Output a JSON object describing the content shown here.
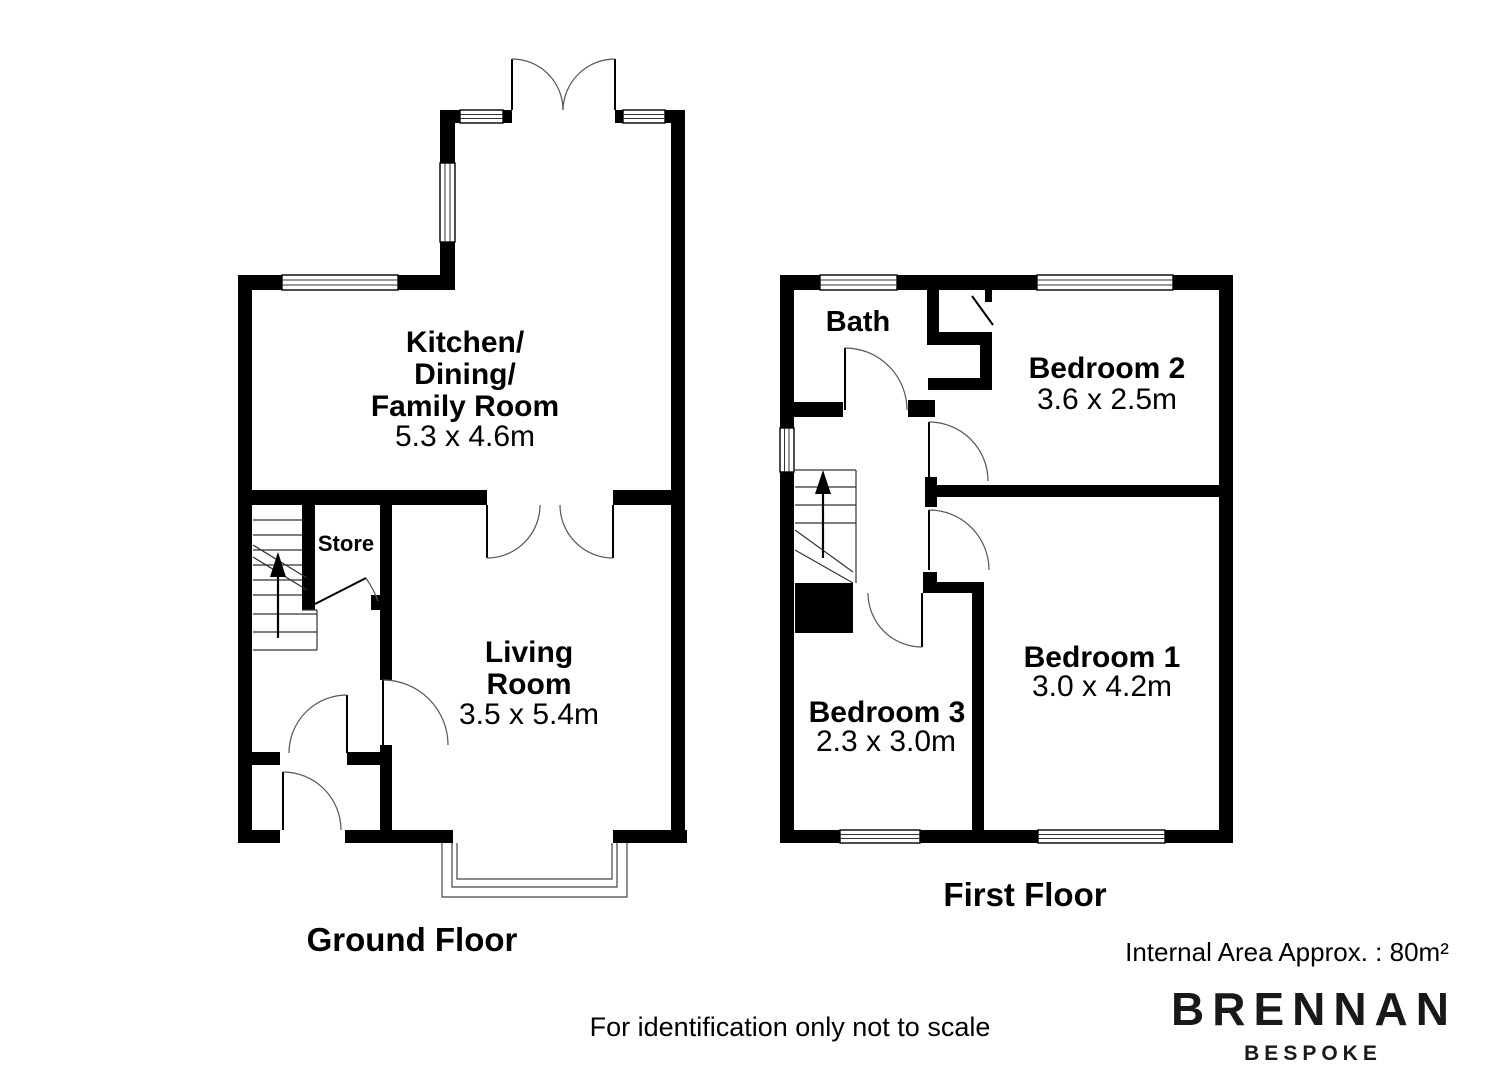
{
  "ground_floor": {
    "title": "Ground Floor",
    "kitchen": {
      "line1": "Kitchen/",
      "line2": "Dining/",
      "line3": "Family Room",
      "dims": "5.3 x 4.6m"
    },
    "living": {
      "line1": "Living",
      "line2": "Room",
      "dims": "3.5 x 5.4m"
    },
    "store": {
      "name": "Store"
    }
  },
  "first_floor": {
    "title": "First Floor",
    "bath": {
      "name": "Bath"
    },
    "bedroom2": {
      "name": "Bedroom 2",
      "dims": "3.6 x 2.5m"
    },
    "bedroom1": {
      "name": "Bedroom 1",
      "dims": "3.0 x 4.2m"
    },
    "bedroom3": {
      "name": "Bedroom 3",
      "dims": "2.3 x 3.0m"
    }
  },
  "footer": {
    "disclaimer": "For identification only not to scale",
    "internal_area": "Internal Area Approx. : 80m²"
  },
  "branding": {
    "name": "BRENNAN",
    "tagline": "BESPOKE"
  },
  "colors": {
    "wall": "#000000",
    "background": "#ffffff"
  }
}
